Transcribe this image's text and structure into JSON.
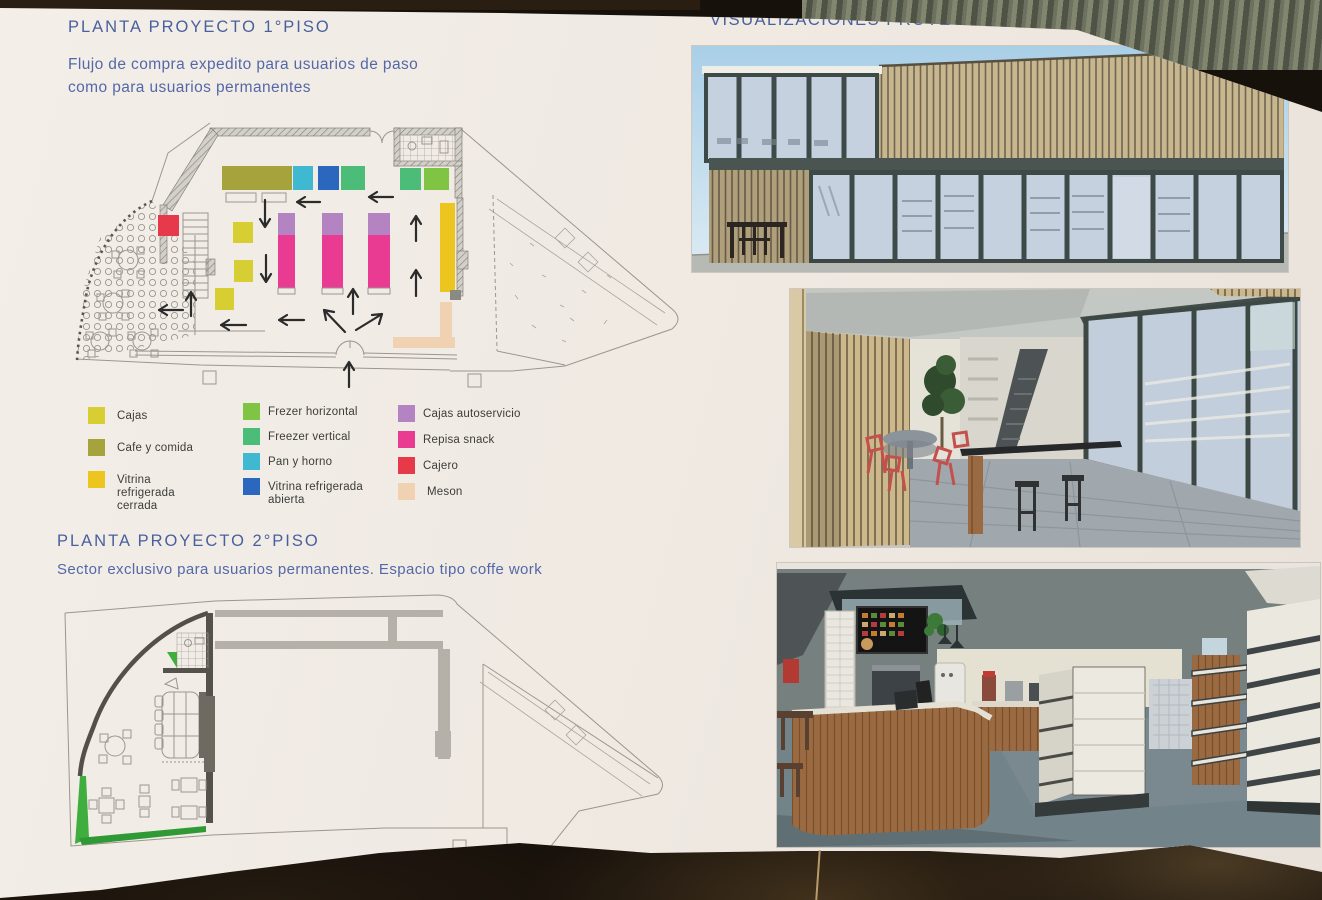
{
  "sections": {
    "plan1": {
      "title": "PLANTA PROYECTO 1°PISO",
      "subtitle_line1": "Flujo de compra expedito para usuarios de paso",
      "subtitle_line2": "como para usuarios permanentes"
    },
    "plan2": {
      "title": "PLANTA PROYECTO 2°PISO",
      "subtitle": "Sector exclusivo para usuarios permanentes. Espacio tipo coffe work"
    },
    "visualizations": {
      "title": "VISUALIZACIÓNES PROYECTO"
    }
  },
  "legend": {
    "items": [
      {
        "label": "Cajas",
        "color": "#d6ce33"
      },
      {
        "label": "Cafe y comida",
        "color": "#a6a33c"
      },
      {
        "label": "Vitrina refrigerada cerrada",
        "color": "#ecc51f"
      },
      {
        "label": "Frezer horizontal",
        "color": "#7fc443"
      },
      {
        "label": "Freezer vertical",
        "color": "#4cbd78"
      },
      {
        "label": "Pan y horno",
        "color": "#3fb9d1"
      },
      {
        "label": "Vitrina refrigerada abierta",
        "color": "#2b67bf"
      },
      {
        "label": "Cajas autoservicio",
        "color": "#b383c2"
      },
      {
        "label": "Repisa snack",
        "color": "#e93b91"
      },
      {
        "label": "Cajero",
        "color": "#e6394a"
      },
      {
        "label": "Meson",
        "color": "#f0d2b2"
      }
    ]
  },
  "colors": {
    "cajas": "#d6ce33",
    "cafe": "#a6a33c",
    "vitrina_cerrada": "#ecc51f",
    "frezer_horizontal": "#7fc443",
    "freezer_vertical": "#4cbd78",
    "pan_horno": "#3fb9d1",
    "vitrina_abierta": "#2b67bf",
    "autoservicio": "#b383c2",
    "repisa_snack": "#e93b91",
    "cajero": "#e6394a",
    "meson": "#f0d2b2",
    "heading_blue": "#49609e",
    "body_blue": "#5468a8",
    "paper": "#efe9e2",
    "background_dark": "#17110b",
    "plan_line": "#9b968e",
    "grass_green": "#3fae3f",
    "wood_slat": "#c7b68e",
    "frame_dark": "#3e4a47",
    "sky_blue": "#aed2e9",
    "glass_blue": "#c6d1e0",
    "render_wall_gray": "#75807f",
    "counter_wood": "#9a6a42",
    "chair_red": "#c4504e",
    "plant_green": "#2f4a2c",
    "floor_gray": "#8f9aa0"
  }
}
